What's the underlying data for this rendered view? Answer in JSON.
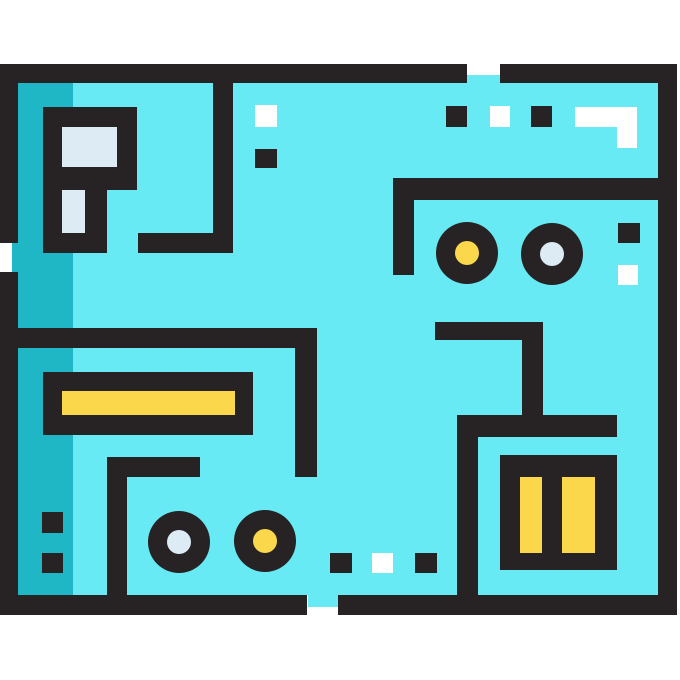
{
  "canvas": {
    "width": 680,
    "height": 680,
    "background": "#ffffff"
  },
  "palette": {
    "black": "#272223",
    "cyan": "#67EAF3",
    "teal": "#1FB7C6",
    "yellow": "#FBD84B",
    "pale_blue": "#DCEBF4",
    "white": "#FFFFFF"
  },
  "shapes": [
    {
      "name": "board-fill",
      "type": "rect",
      "x": 18,
      "y": 83,
      "w": 640,
      "h": 512,
      "fill": "cyan"
    },
    {
      "name": "board-shade-strip",
      "type": "rect",
      "x": 18,
      "y": 83,
      "w": 55,
      "h": 512,
      "fill": "teal"
    },
    {
      "name": "board-tab-top-gap",
      "type": "rect",
      "x": 467,
      "y": 75,
      "w": 33,
      "h": 8,
      "fill": "cyan"
    },
    {
      "name": "board-tab-left-gap",
      "type": "rect",
      "x": 12,
      "y": 243,
      "w": 6,
      "h": 29,
      "fill": "teal"
    },
    {
      "name": "board-tab-bottom-gap",
      "type": "rect",
      "x": 308,
      "y": 595,
      "w": 30,
      "h": 12,
      "fill": "cyan"
    },
    {
      "name": "border-top-left-segment",
      "type": "rect",
      "x": 0,
      "y": 64,
      "w": 467,
      "h": 19,
      "fill": "black"
    },
    {
      "name": "border-top-right-segment",
      "type": "rect",
      "x": 500,
      "y": 64,
      "w": 177,
      "h": 19,
      "fill": "black"
    },
    {
      "name": "border-bottom-left-segment",
      "type": "rect",
      "x": 0,
      "y": 595,
      "w": 307,
      "h": 20,
      "fill": "black"
    },
    {
      "name": "border-bottom-right-segment",
      "type": "rect",
      "x": 338,
      "y": 595,
      "w": 339,
      "h": 20,
      "fill": "black"
    },
    {
      "name": "border-left-upper-segment",
      "type": "rect",
      "x": 0,
      "y": 64,
      "w": 18,
      "h": 179,
      "fill": "black"
    },
    {
      "name": "border-left-lower-segment",
      "type": "rect",
      "x": 0,
      "y": 272,
      "w": 18,
      "h": 343,
      "fill": "black"
    },
    {
      "name": "border-right",
      "type": "rect",
      "x": 658,
      "y": 64,
      "w": 19,
      "h": 551,
      "fill": "black"
    },
    {
      "name": "chip-topleft-body",
      "type": "rect",
      "x": 43,
      "y": 107,
      "w": 94,
      "h": 83,
      "fill": "black"
    },
    {
      "name": "chip-topleft-stem",
      "type": "rect",
      "x": 43,
      "y": 107,
      "w": 64,
      "h": 146,
      "fill": "black"
    },
    {
      "name": "chip-topleft-window-upper",
      "type": "rect",
      "x": 62,
      "y": 127,
      "w": 55,
      "h": 40,
      "fill": "pale_blue"
    },
    {
      "name": "chip-topleft-window-lower",
      "type": "rect",
      "x": 62,
      "y": 190,
      "w": 23,
      "h": 43,
      "fill": "pale_blue"
    },
    {
      "name": "trace-topleft-vertical",
      "type": "rect",
      "x": 213,
      "y": 83,
      "w": 20,
      "h": 170,
      "fill": "black"
    },
    {
      "name": "trace-topleft-horizontal",
      "type": "rect",
      "x": 138,
      "y": 233,
      "w": 95,
      "h": 20,
      "fill": "black"
    },
    {
      "name": "solder-pad-white-topcenter",
      "type": "rect",
      "x": 255,
      "y": 105,
      "w": 22,
      "h": 22,
      "fill": "white"
    },
    {
      "name": "solder-pad-black-topcenter",
      "type": "rect",
      "x": 255,
      "y": 149,
      "w": 22,
      "h": 19,
      "fill": "black"
    },
    {
      "name": "solder-pad-black-topright-1",
      "type": "rect",
      "x": 446,
      "y": 106,
      "w": 21,
      "h": 21,
      "fill": "black"
    },
    {
      "name": "solder-pad-white-topright",
      "type": "rect",
      "x": 490,
      "y": 106,
      "w": 20,
      "h": 21,
      "fill": "white"
    },
    {
      "name": "solder-pad-black-topright-2",
      "type": "rect",
      "x": 531,
      "y": 106,
      "w": 21,
      "h": 21,
      "fill": "black"
    },
    {
      "name": "trace-white-l-horizontal",
      "type": "rect",
      "x": 575,
      "y": 107,
      "w": 62,
      "h": 20,
      "fill": "white"
    },
    {
      "name": "trace-white-l-vertical",
      "type": "rect",
      "x": 617,
      "y": 107,
      "w": 20,
      "h": 41,
      "fill": "white"
    },
    {
      "name": "bracket-topright-horizontal",
      "type": "rect",
      "x": 393,
      "y": 178,
      "w": 284,
      "h": 22,
      "fill": "black"
    },
    {
      "name": "bracket-topright-vertical",
      "type": "rect",
      "x": 393,
      "y": 178,
      "w": 21,
      "h": 97,
      "fill": "black"
    },
    {
      "name": "via-topright-left-ring",
      "type": "circle",
      "cx": 467,
      "cy": 253,
      "r": 31,
      "fill": "black"
    },
    {
      "name": "via-topright-left-core-yellow",
      "type": "circle",
      "cx": 467,
      "cy": 253,
      "r": 12,
      "fill": "yellow"
    },
    {
      "name": "via-topright-right-ring",
      "type": "circle",
      "cx": 552,
      "cy": 254,
      "r": 31,
      "fill": "black"
    },
    {
      "name": "via-topright-right-core-pale",
      "type": "circle",
      "cx": 552,
      "cy": 254,
      "r": 12,
      "fill": "pale_blue"
    },
    {
      "name": "pad-black-right-edge",
      "type": "rect",
      "x": 618,
      "y": 223,
      "w": 22,
      "h": 20,
      "fill": "black"
    },
    {
      "name": "pad-white-right-edge",
      "type": "rect",
      "x": 618,
      "y": 265,
      "w": 20,
      "h": 20,
      "fill": "white"
    },
    {
      "name": "trace-midright-horizontal",
      "type": "rect",
      "x": 435,
      "y": 322,
      "w": 108,
      "h": 18,
      "fill": "black"
    },
    {
      "name": "trace-midright-vertical",
      "type": "rect",
      "x": 522,
      "y": 322,
      "w": 21,
      "h": 95,
      "fill": "black"
    },
    {
      "name": "bracket-bottomright-horizontal",
      "type": "rect",
      "x": 457,
      "y": 415,
      "w": 160,
      "h": 22,
      "fill": "black"
    },
    {
      "name": "bracket-bottomright-vertical",
      "type": "rect",
      "x": 457,
      "y": 415,
      "w": 21,
      "h": 180,
      "fill": "black"
    },
    {
      "name": "battery-body",
      "type": "rect",
      "x": 500,
      "y": 455,
      "w": 117,
      "h": 115,
      "fill": "black"
    },
    {
      "name": "battery-cell-left-yellow",
      "type": "rect",
      "x": 520,
      "y": 477,
      "w": 22,
      "h": 76,
      "fill": "yellow"
    },
    {
      "name": "battery-cell-right-yellow",
      "type": "rect",
      "x": 562,
      "y": 477,
      "w": 33,
      "h": 76,
      "fill": "yellow"
    },
    {
      "name": "trace-center-horizontal",
      "type": "rect",
      "x": 0,
      "y": 328,
      "w": 317,
      "h": 20,
      "fill": "black"
    },
    {
      "name": "trace-center-vertical",
      "type": "rect",
      "x": 295,
      "y": 328,
      "w": 22,
      "h": 149,
      "fill": "black"
    },
    {
      "name": "resistor-body",
      "type": "rect",
      "x": 43,
      "y": 372,
      "w": 210,
      "h": 63,
      "fill": "black"
    },
    {
      "name": "resistor-band-yellow",
      "type": "rect",
      "x": 62,
      "y": 391,
      "w": 173,
      "h": 24,
      "fill": "yellow"
    },
    {
      "name": "trace-bottomleft-horizontal",
      "type": "rect",
      "x": 107,
      "y": 457,
      "w": 93,
      "h": 20,
      "fill": "black"
    },
    {
      "name": "trace-bottomleft-vertical",
      "type": "rect",
      "x": 107,
      "y": 457,
      "w": 20,
      "h": 138,
      "fill": "black"
    },
    {
      "name": "pad-black-left-strip-1",
      "type": "rect",
      "x": 42,
      "y": 512,
      "w": 21,
      "h": 21,
      "fill": "black"
    },
    {
      "name": "pad-black-left-strip-2",
      "type": "rect",
      "x": 42,
      "y": 553,
      "w": 21,
      "h": 20,
      "fill": "black"
    },
    {
      "name": "via-bottomleft-left-ring",
      "type": "circle",
      "cx": 179,
      "cy": 542,
      "r": 31,
      "fill": "black"
    },
    {
      "name": "via-bottomleft-left-core-pale",
      "type": "circle",
      "cx": 179,
      "cy": 542,
      "r": 12,
      "fill": "pale_blue"
    },
    {
      "name": "via-bottomleft-right-ring",
      "type": "circle",
      "cx": 265,
      "cy": 541,
      "r": 31,
      "fill": "black"
    },
    {
      "name": "via-bottomleft-right-core-yellow",
      "type": "circle",
      "cx": 265,
      "cy": 541,
      "r": 12,
      "fill": "yellow"
    },
    {
      "name": "solder-pad-black-bottom-1",
      "type": "rect",
      "x": 330,
      "y": 553,
      "w": 22,
      "h": 20,
      "fill": "black"
    },
    {
      "name": "solder-pad-white-bottom",
      "type": "rect",
      "x": 372,
      "y": 553,
      "w": 21,
      "h": 20,
      "fill": "white"
    },
    {
      "name": "solder-pad-black-bottom-2",
      "type": "rect",
      "x": 415,
      "y": 553,
      "w": 22,
      "h": 20,
      "fill": "black"
    }
  ]
}
